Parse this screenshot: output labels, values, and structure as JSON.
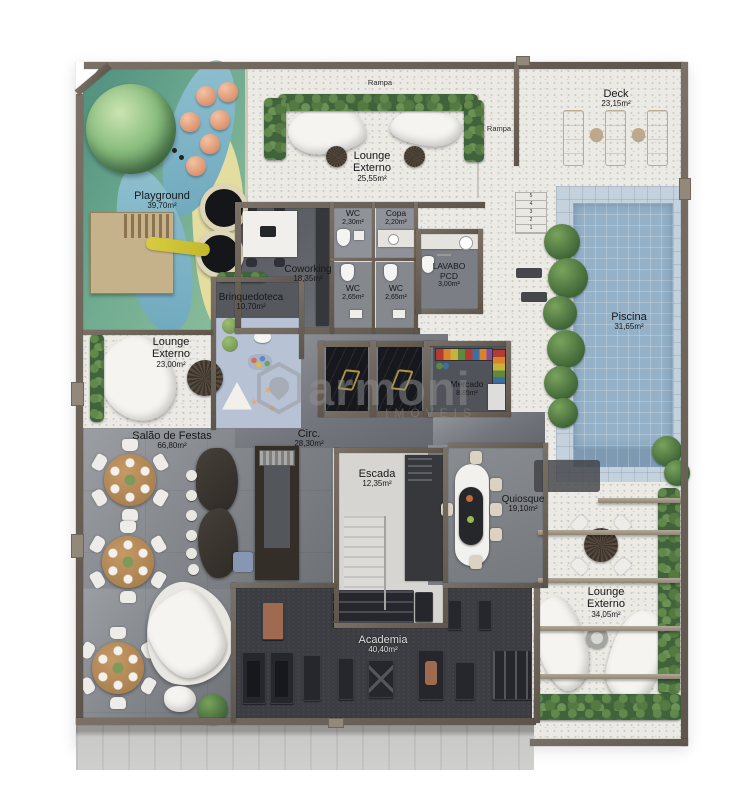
{
  "watermark": {
    "brand": "armoni",
    "tagline": "IMÓVEIS"
  },
  "labels": {
    "rampa_top": "Rampa",
    "rampa_right": "Rampa"
  },
  "stair_labels": [
    "5",
    "4",
    "3",
    "2",
    "1"
  ],
  "rooms": {
    "playground": {
      "name": "Playground",
      "area": "39,70m²"
    },
    "lounge_top": {
      "name": "Lounge Externo",
      "area": "25,55m²"
    },
    "deck": {
      "name": "Deck",
      "area": "23,15m²"
    },
    "wc_top": {
      "name": "WC",
      "area": "2,30m²"
    },
    "copa": {
      "name": "Copa",
      "area": "2,20m²"
    },
    "coworking": {
      "name": "Coworking",
      "area": "18,35m²"
    },
    "wc_mid_left": {
      "name": "WC",
      "area": "2,65m²"
    },
    "wc_mid_right": {
      "name": "WC",
      "area": "2,65m²"
    },
    "lavabo_pcd": {
      "name": "LAVABO PCD",
      "area": "3,00m²"
    },
    "brinquedoteca": {
      "name": "Brinquedoteca",
      "area": "10,70m²"
    },
    "lounge_left": {
      "name": "Lounge Externo",
      "area": "23,00m²"
    },
    "piscina": {
      "name": "Piscina",
      "area": "31,65m²"
    },
    "mercado": {
      "name": "Mercado",
      "area": "8,85m²"
    },
    "circ": {
      "name": "Circ.",
      "area": "28,30m²"
    },
    "salao": {
      "name": "Salão de Festas",
      "area": "66,80m²"
    },
    "escada": {
      "name": "Escada",
      "area": "12,35m²"
    },
    "quiosque": {
      "name": "Quiosque",
      "area": "19,10m²"
    },
    "academia": {
      "name": "Academia",
      "area": "40,40m²"
    },
    "lounge_bottom": {
      "name": "Lounge Externo",
      "area": "34,05m²"
    }
  },
  "palette": {
    "wall": "#6b6157",
    "outdoor_floor": "#eceae5",
    "interior_floor": "#73767c",
    "gym_floor": "#3b3d42",
    "pool_water": "#95b1c7",
    "grass": "#6faa90",
    "sand": "#e4dda0",
    "path": "#7fb4c6",
    "hedge": "#41633b",
    "wood": "#b68a58",
    "gold": "#ac9242",
    "play_mat": "#b7c2d5",
    "watermark_gray": "#8f8f8f"
  }
}
